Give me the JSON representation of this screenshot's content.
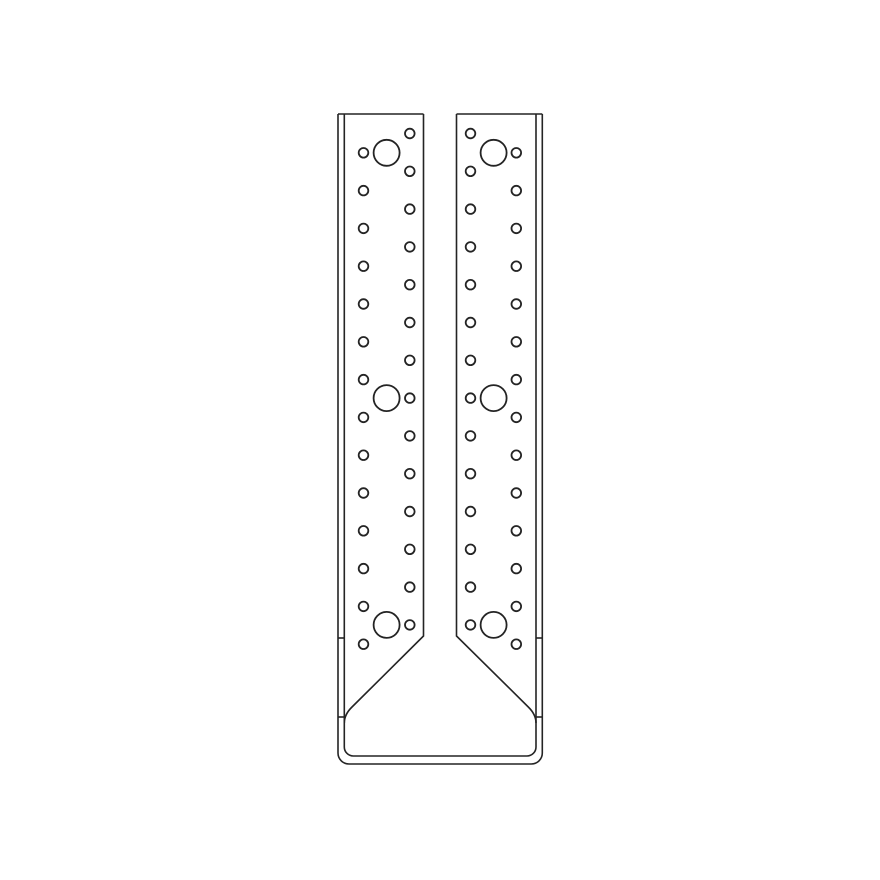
{
  "canvas": {
    "width": 880,
    "height": 880,
    "background": "#ffffff"
  },
  "style": {
    "line_color": "#242424",
    "line_width": 1.6,
    "hole_line_width": 1.8
  },
  "drawing": {
    "paths": [
      {
        "name": "left-flange-top-edge",
        "d": "M 338 114 H 423.5"
      },
      {
        "name": "right-flange-top-edge",
        "d": "M 456.5 114 H 542.3"
      },
      {
        "name": "outer-contour",
        "d": "M 338 114 V 753 A 11 11 0 0 0 349 764 H 531.3 A 11 11 0 0 0 542.3 753 V 114"
      },
      {
        "name": "bend-line-contour",
        "d": "M 344.3 114 V 747 A 9 9 0 0 0 353.3 756 H 527 A 9 9 0 0 0 536 747 V 114"
      },
      {
        "name": "left-web-edge-and-taper",
        "d": "M 423.5 114 V 636 L 352 707 Q 344.3 714.5 344.3 723"
      },
      {
        "name": "right-web-edge-and-taper",
        "d": "M 456.5 114 V 636 L 528.3 707 Q 536 714.5 536 723"
      },
      {
        "name": "left-bend-tick-upper",
        "d": "M 338 638 H 344.3"
      },
      {
        "name": "right-bend-tick-upper",
        "d": "M 536 638 H 542.3"
      },
      {
        "name": "left-bend-tick-lower",
        "d": "M 338 717 H 344.3"
      },
      {
        "name": "right-bend-tick-lower",
        "d": "M 536 717 H 542.3"
      }
    ],
    "holes": {
      "small_radius": 4.8,
      "large_radius": 13,
      "columns": [
        {
          "name": "left-flange-outer-column",
          "x": 363.5,
          "y_start": 152.8,
          "spacing": 37.8,
          "count": 14
        },
        {
          "name": "left-flange-inner-column",
          "x": 409.8,
          "y_start": 133.5,
          "spacing": 37.8,
          "count": 14
        },
        {
          "name": "right-flange-inner-column",
          "x": 470.5,
          "y_start": 133.5,
          "spacing": 37.8,
          "count": 14
        },
        {
          "name": "right-flange-outer-column",
          "x": 516.3,
          "y_start": 152.8,
          "spacing": 37.8,
          "count": 14
        }
      ],
      "large": [
        {
          "x": 386.6,
          "y": 152.8
        },
        {
          "x": 386.6,
          "y": 398.1
        },
        {
          "x": 386.6,
          "y": 624.9
        },
        {
          "x": 493.6,
          "y": 152.8
        },
        {
          "x": 493.6,
          "y": 398.1
        },
        {
          "x": 493.6,
          "y": 624.9
        }
      ]
    }
  }
}
